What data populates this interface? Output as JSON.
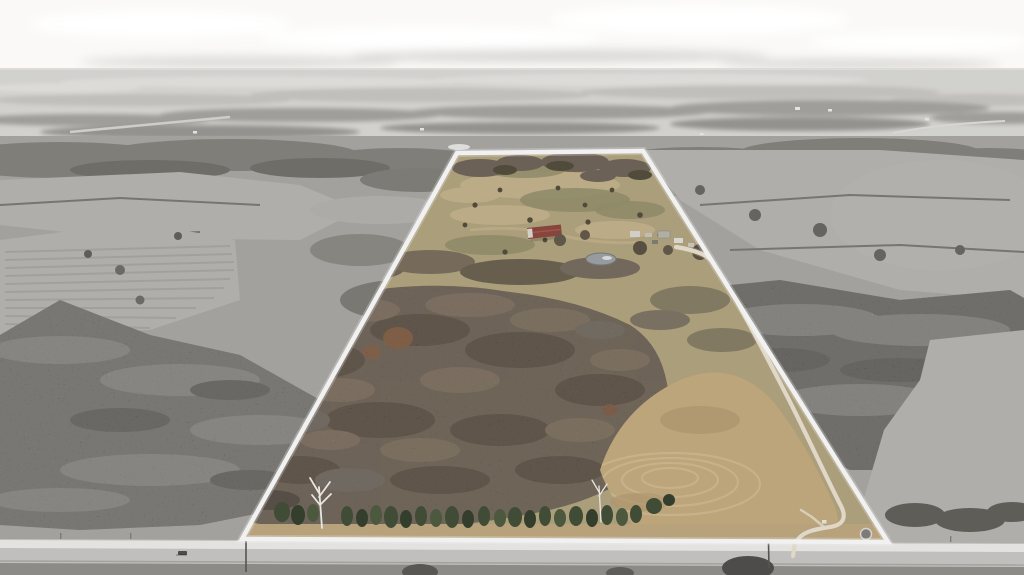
{
  "image": {
    "kind": "aerial-drone-photo",
    "width": 1024,
    "height": 575,
    "description": "Winter aerial real-estate photo of a rural acreage. The offered parcel is a tall trapezoid shown in natural color and outlined with a white boundary line; all surrounding countryside is desaturated to grayscale. A light gray county road runs along the bottom edge. Inside the parcel: open tan pasture at the top with scattered shrubs, a farmstead with a red-roofed barn, white outbuildings and a small pond, a large block of bare brown hardwood timber in the middle, a mowed hay field with circular cutting arcs at lower right, a row of dark green cedar trees along the road frontage, and a cream gravel driveway running from the road up along the east boundary to the farmstead. Gray winter woods, crop fields, hedgerows and distant farms fill the background beneath a pale overcast sky."
  },
  "boundary": {
    "points": "457,153 643,151 888,542 242,539",
    "stroke_width": 4.5,
    "color": "#ffffff"
  },
  "driveway": {
    "path": "M 676,247 C 700,251 712,257 719,269 C 735,297 761,346 787,396 C 807,435 827,479 841,506 C 847,518 843,525 830,527 C 817,529 805,531 799,538 C 796,542 795,547 795,553",
    "spur": "M 824,527 L 812,517 L 801,510",
    "stub": "M 795,541 L 793,556"
  },
  "colors": {
    "sky-top": "#faf9f7",
    "cloud": "#ffffff",
    "cloud-shadow": "#d8d7d5",
    "haze": "#dcdbd8",
    "distant-light": "#e8e7e4",
    "distant-mid": "#c9c8c5",
    "distant-tree": "#a5a39f",
    "distant-tree2": "#989793",
    "farm-speck": "#f1f0ee",
    "gray-field": "#a9a7a3",
    "gray-field-light": "#b7b5b1",
    "hedge": "#78766f",
    "gray-forest": "#76746e",
    "gray-forest-light": "#908e89",
    "gray-forest-dark": "#5e5c56",
    "right-forest": "#6e6c66",
    "road": "#c9c8c6",
    "road-stripe": "#f0efed",
    "road-shoulder": "#908e8b",
    "below-road-tree": "#4b4a46",
    "pasture": "#b2a37c",
    "pasture-light": "#c4b28a",
    "pasture-olive": "#948d68",
    "shrub": "#4e4736",
    "clump": "#6b6054",
    "woodland": "#7a6954",
    "woodland-dark": "#60503c",
    "woodland-light": "#8f7a60",
    "woodland-gray": "#7d7264",
    "rust": "#9a6038",
    "field": "#c5aa7d",
    "field-arc": "#d6bd90",
    "field-dark": "#b49a6f",
    "evergreen": "#3c4a31",
    "evergreen-dark": "#2e3a26",
    "evergreen-light": "#49573b",
    "grass-strip": "#bfa87e",
    "pond": "#9aa0a4",
    "pond-glint": "#e9eef1",
    "barn-roof": "#8a4239",
    "barn-ridge": "#aa5649",
    "building-white": "#dcd9d3",
    "driveway": "#ece3d0",
    "driveway-edge": "#b6a384",
    "birch": "#f3f2ef",
    "boundary": "#ffffff",
    "pole": "#53524d"
  },
  "objects": [
    {
      "name": "property-boundary",
      "desc": "white trapezoid outline around the colored parcel"
    },
    {
      "name": "county-road",
      "desc": "light gray road running across the full bottom of the photo"
    },
    {
      "name": "barn",
      "desc": "long red/maroon-roofed barn at the farmstead",
      "x": 543,
      "y": 233
    },
    {
      "name": "outbuildings",
      "desc": "white sheds, trailers and vehicles east of the barn",
      "x": 660,
      "y": 236
    },
    {
      "name": "pond",
      "desc": "small gray farm pond with bright reflection",
      "x": 601,
      "y": 259
    },
    {
      "name": "gravel-driveway",
      "desc": "cream gravel drive from road up the east boundary to the farmstead"
    },
    {
      "name": "hardwood-timber",
      "desc": "large block of bare brown winter hardwoods in parcel center"
    },
    {
      "name": "hay-field",
      "desc": "tan mowed field with concentric cutting arcs, lower-right of parcel"
    },
    {
      "name": "evergreen-row",
      "desc": "row of dark green cedars along the road frontage"
    },
    {
      "name": "birch-tree",
      "desc": "white-barked tree at the wood edge",
      "x": 322,
      "y": 505
    },
    {
      "name": "round-feeder",
      "desc": "small round tank/feeder near the SE corner",
      "x": 866,
      "y": 534
    },
    {
      "name": "utility-pole",
      "desc": "pole beside the road",
      "x": 768,
      "y": 543
    },
    {
      "name": "vehicle-on-road",
      "desc": "small dark vehicle on the road at left",
      "x": 183,
      "y": 551
    },
    {
      "name": "distant-farmsteads",
      "desc": "tiny white farm buildings on the gray horizon"
    }
  ]
}
